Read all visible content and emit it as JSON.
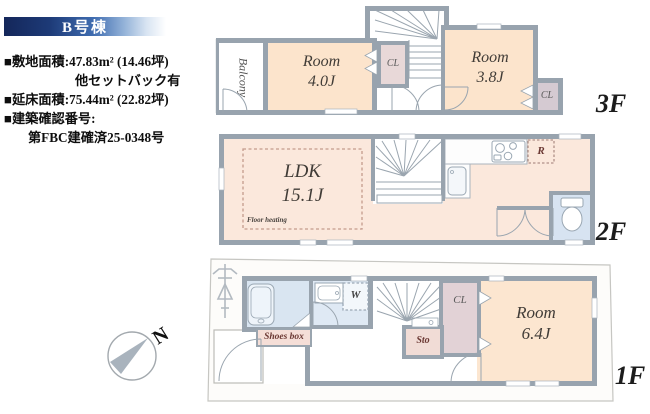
{
  "header": {
    "title": "B号棟"
  },
  "property_info": {
    "lines": [
      "■敷地面積:47.83m² (14.46坪)",
      "他セットバック有",
      "■延床面積:75.44m² (22.82坪)",
      "■建築確認番号:",
      "第FBC建確済25-0348号"
    ]
  },
  "floor3": {
    "label": "3F",
    "balcony_label": "Balcony",
    "room_a_name": "Room",
    "room_a_size": "4.0J",
    "closet_a_label": "CL",
    "room_b_name": "Room",
    "room_b_size": "3.8J",
    "closet_b_label": "CL"
  },
  "floor2": {
    "label": "2F",
    "ldk_name": "LDK",
    "ldk_size": "15.1J",
    "floor_heating_label": "Floor heating",
    "refrigerator_label": "R"
  },
  "floor1": {
    "label": "1F",
    "room_name": "Room",
    "room_size": "6.4J",
    "closet_label": "CL",
    "storage_label": "Sto",
    "washer_label": "W",
    "shoes_box_label": "Shoes box"
  },
  "compass": {
    "north_label": "N"
  },
  "colors": {
    "header_gradient_start": "#14275a",
    "header_gradient_mid": "#3f6cb0",
    "header_gradient_end": "#ffffff",
    "wall": "#98a3ae",
    "room_fill": "#fce4cc",
    "ldk_fill": "#fbe8dc",
    "wet_area_fill": "#d9e5f1",
    "closet_fill": "#e6d6d8",
    "storage_fill": "#f1dcd6",
    "site_fill": "#fdfcfa",
    "dark_red_label": "#6b3833"
  }
}
